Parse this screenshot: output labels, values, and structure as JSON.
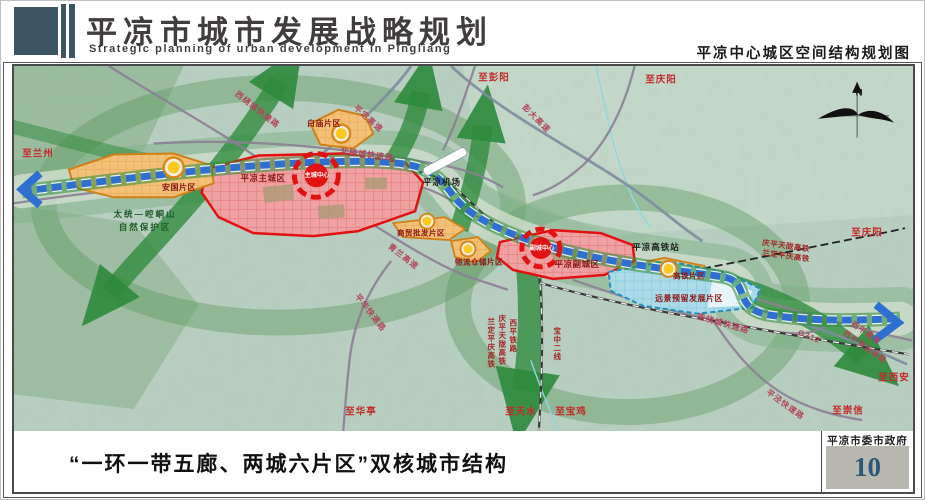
{
  "header": {
    "title": "平凉市城市发展战略规划",
    "subtitle": "Strategic planning of urban development in Pingliang",
    "right_caption": "平凉中心城区空间结构规划图"
  },
  "footer": {
    "caption": "“一环一带五廊、两城六片区”双核城市结构",
    "agency": "平凉市委市政府",
    "page_number": "10"
  },
  "map": {
    "colors": {
      "header_slate": "#3b5565",
      "map_background": "#b9cfc1",
      "corridor_green": "#2e8a3c",
      "axis_blue": "#2e6fd0",
      "core_red": "#e01212",
      "zone_red_fill": "#f0a2a2",
      "zone_orange_fill": "#f3c077",
      "zone_blue_fill": "#abdbe9",
      "node_yellow": "#fdc822",
      "page_number_blue": "#2c5878"
    },
    "labels": [
      {
        "text": "至兰州",
        "x": 24,
        "y": 88,
        "cls": "dir"
      },
      {
        "text": "至彭阳",
        "x": 480,
        "y": 12,
        "cls": "dir"
      },
      {
        "text": "至庆阳",
        "x": 647,
        "y": 14,
        "cls": "dir"
      },
      {
        "text": "至庆阳",
        "x": 853,
        "y": 167,
        "cls": "dir"
      },
      {
        "text": "至西安",
        "x": 880,
        "y": 312,
        "cls": "dir"
      },
      {
        "text": "至崇信",
        "x": 834,
        "y": 345,
        "cls": "dir"
      },
      {
        "text": "至华亭",
        "x": 347,
        "y": 346,
        "cls": "dir"
      },
      {
        "text": "至天水",
        "x": 507,
        "y": 346,
        "cls": "dir"
      },
      {
        "text": "至宝鸡",
        "x": 557,
        "y": 346,
        "cls": "dir"
      },
      {
        "text": "西绕城快速路",
        "x": 243,
        "y": 44,
        "cls": "road",
        "rot": 38
      },
      {
        "text": "平定高速",
        "x": 354,
        "y": 53,
        "cls": "road",
        "rot": 42
      },
      {
        "text": "彭大高速",
        "x": 522,
        "y": 53,
        "cls": "road",
        "rot": 45
      },
      {
        "text": "北绕城快速路",
        "x": 353,
        "y": 89,
        "cls": "road",
        "rot": 8
      },
      {
        "text": "青兰高速",
        "x": 389,
        "y": 191,
        "cls": "road",
        "rot": 38
      },
      {
        "text": "平华快速路",
        "x": 356,
        "y": 247,
        "cls": "road",
        "rot": 52
      },
      {
        "text": "南绕城快速路",
        "x": 709,
        "y": 258,
        "cls": "road",
        "rot": 16
      },
      {
        "text": "G312",
        "x": 795,
        "y": 271,
        "cls": "road",
        "rot": 22,
        "fs": 8
      },
      {
        "text": "西平高速",
        "x": 852,
        "y": 267,
        "cls": "road",
        "rot": 35,
        "fs": 7.5
      },
      {
        "text": "西平货运铁路",
        "x": 851,
        "y": 281,
        "cls": "road",
        "rot": 35,
        "fs": 7.5
      },
      {
        "text": "平泾快速路",
        "x": 771,
        "y": 339,
        "cls": "road",
        "rot": 36
      },
      {
        "text": "庆平天陇高铁",
        "x": 772,
        "y": 180,
        "cls": "raild",
        "rot": 8
      },
      {
        "text": "兰定平庆高铁",
        "x": 772,
        "y": 190,
        "cls": "raild",
        "rot": 8
      },
      {
        "text": "兰定平庆高铁",
        "x": 477,
        "y": 277,
        "cls": "railv"
      },
      {
        "text": "庆平天陇高铁",
        "x": 488,
        "y": 274,
        "cls": "railv"
      },
      {
        "text": "西平铁路",
        "x": 499,
        "y": 270,
        "cls": "railv"
      },
      {
        "text": "宝中二线",
        "x": 543,
        "y": 278,
        "cls": "railv"
      },
      {
        "text": "平凉主城区",
        "x": 249,
        "y": 112,
        "cls": "zone"
      },
      {
        "text": "平凉副城区",
        "x": 563,
        "y": 198,
        "cls": "zone"
      },
      {
        "text": "白庙片区",
        "x": 310,
        "y": 58,
        "cls": "zone",
        "fs": 8
      },
      {
        "text": "安国片区",
        "x": 165,
        "y": 122,
        "cls": "zone",
        "fs": 8
      },
      {
        "text": "商贸批发片区",
        "x": 407,
        "y": 167,
        "cls": "zone",
        "fs": 7.5
      },
      {
        "text": "物流仓储片区",
        "x": 465,
        "y": 196,
        "cls": "zone",
        "fs": 7.5
      },
      {
        "text": "高铁片区",
        "x": 675,
        "y": 210,
        "cls": "zone",
        "fs": 7.5
      },
      {
        "text": "远景预留发展片区",
        "x": 675,
        "y": 233,
        "cls": "zone",
        "fs": 8
      },
      {
        "text": "主城中心",
        "x": 303,
        "y": 110,
        "cls": "core"
      },
      {
        "text": "副城中心",
        "x": 528,
        "y": 183,
        "cls": "core"
      },
      {
        "text": "平凉高铁站",
        "x": 642,
        "y": 181,
        "cls": "blacklbl"
      },
      {
        "text": "平凉机场",
        "x": 428,
        "y": 116,
        "cls": "blacklbl"
      },
      {
        "text": "太统—崆峒山",
        "x": 131,
        "y": 148,
        "cls": "greenlbl"
      },
      {
        "text": "自然保护区",
        "x": 131,
        "y": 161,
        "cls": "greenlbl"
      },
      {
        "text": "N",
        "x": 845,
        "y": 27,
        "cls": "compass"
      }
    ]
  }
}
